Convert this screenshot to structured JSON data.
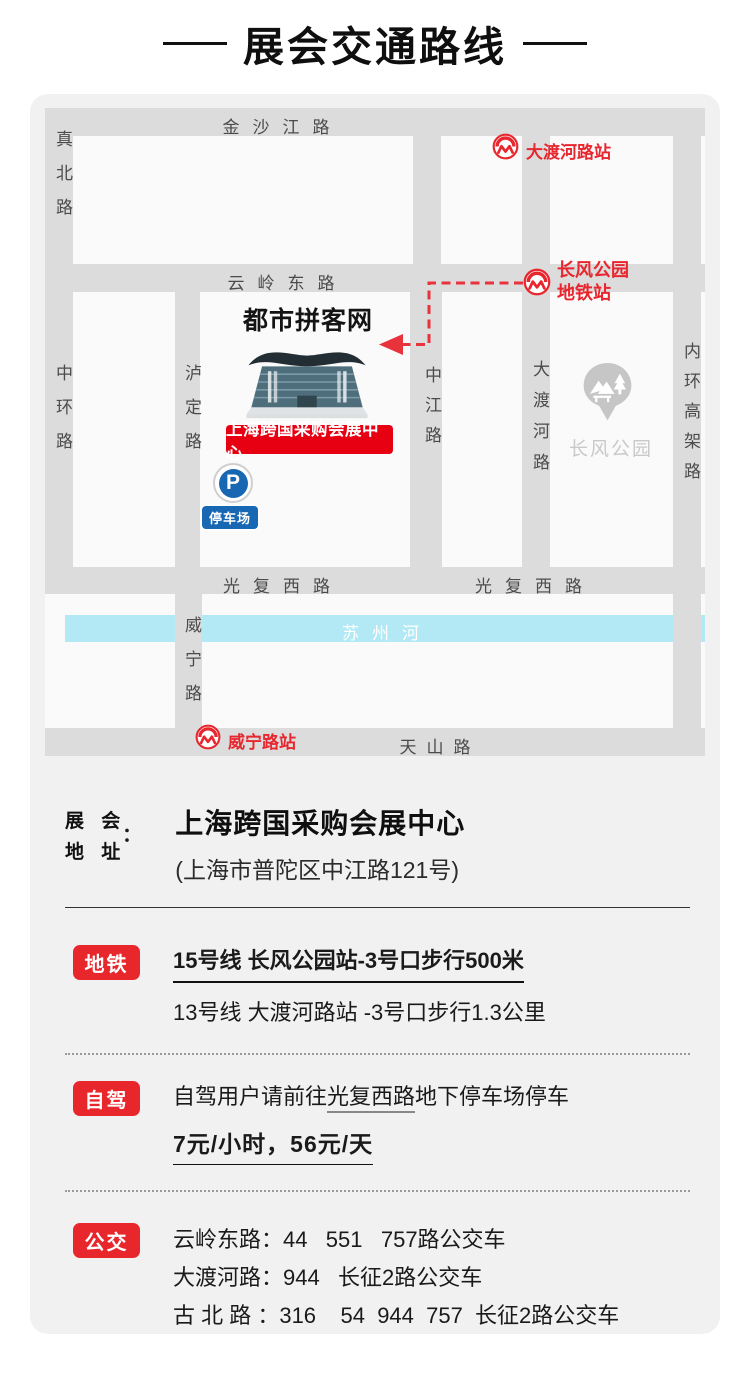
{
  "title": "展会交通路线",
  "colors": {
    "accent_red": "#e8272d",
    "metro_red": "#e8262e",
    "venue_red": "#e60012",
    "parking_blue": "#1767b2",
    "river_cyan": "#b2e9f5",
    "road_gray": "#dcdcdc"
  },
  "map": {
    "roads": {
      "jinshajiang": "金沙江路",
      "zhenbei": "真北路",
      "yunling_east": "云岭东路",
      "zhonghuan": "中环路",
      "luding": "泸定路",
      "zhongjiang": "中江路",
      "daduhe": "大渡河路",
      "neihuan_gaojia": "内环高架路",
      "guangfu_west_left": "光复西路",
      "guangfu_west_right": "光复西路",
      "weining": "威宁路",
      "tianshan": "天山路"
    },
    "river": "苏州河",
    "stations": {
      "daduhe": "大渡河路站",
      "changfeng_line1": "长风公园",
      "changfeng_line2": "地铁站",
      "weining": "威宁路站"
    },
    "park": "长风公园",
    "brand": "都市拼客网",
    "venue_tag": "上海跨国采购会展中心",
    "parking_p": "P",
    "parking_tag": "停车场"
  },
  "address": {
    "label_line1": "展 会",
    "label_line2": "地 址",
    "colon": "：",
    "name": "上海跨国采购会展中心",
    "detail": "(上海市普陀区中江路121号)"
  },
  "metro": {
    "badge": "地铁",
    "line1": "15号线 长风公园站-3号口步行500米",
    "line2": "13号线 大渡河路站 -3号口步行1.3公里"
  },
  "driving": {
    "badge": "自驾",
    "line1_prefix": "自驾用户请前往",
    "line1_road": "光复西路",
    "line1_suffix": "地下停车场停车",
    "line2": "7元/小时，56元/天"
  },
  "bus": {
    "badge": "公交",
    "lines": [
      "云岭东路：44   551   757路公交车",
      "大渡河路：944   长征2路公交车",
      "古 北 路 ：316    54  944  757  长征2路公交车",
      "天山西路：71  72  74  141 311  808  251 825",
      "829  856  941   944  190路公交车"
    ]
  }
}
